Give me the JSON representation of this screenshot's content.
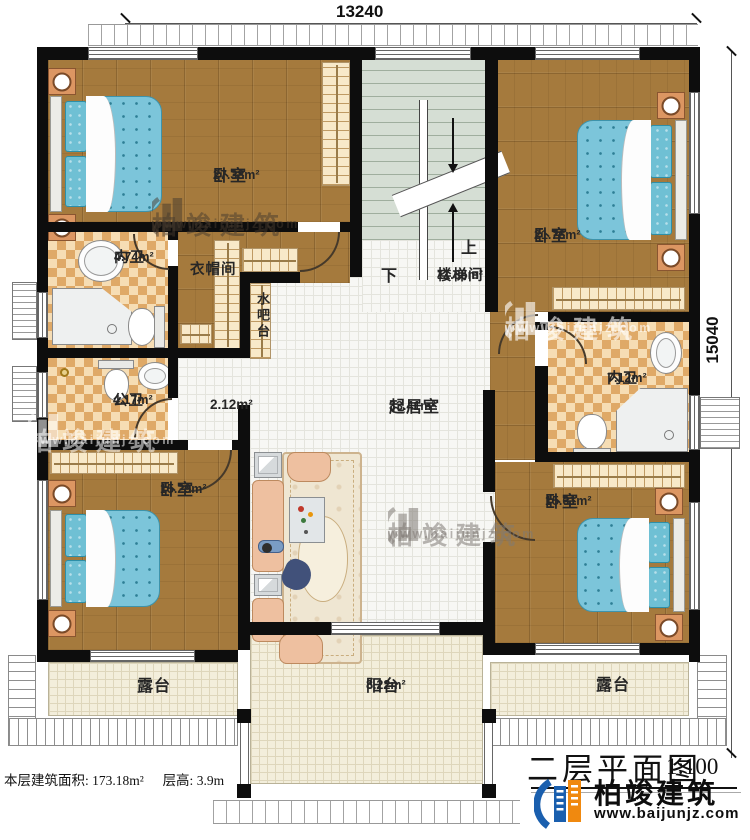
{
  "dimensions": {
    "top": "13240",
    "right": "15040"
  },
  "rooms": {
    "bedroom1": {
      "name": "卧室",
      "area": "27.38m²"
    },
    "bedroom2": {
      "name": "卧室",
      "area": "21.76m²"
    },
    "bedroom3": {
      "name": "卧室",
      "area": "15.29m²"
    },
    "bedroom4": {
      "name": "卧室",
      "area": "15.61m²"
    },
    "bath1": {
      "name": "内卫",
      "area": "4.74m²"
    },
    "bath2": {
      "name": "内卫",
      "area": "7.12m²"
    },
    "public_bath": {
      "name": "公卫",
      "area": "4.17m²"
    },
    "cloakroom": {
      "name": "衣帽间"
    },
    "water_bar": {
      "name": "水吧台"
    },
    "stairwell": {
      "name": "楼梯间",
      "area": "11.35m²",
      "up": "上",
      "down": "下"
    },
    "hallway": {
      "area": "2.12m²"
    },
    "living": {
      "name": "起居室",
      "area": "33.41m²"
    },
    "terrace_left": {
      "name": "露台"
    },
    "terrace_right": {
      "name": "露台"
    },
    "balcony": {
      "name": "阳台",
      "area": "8.22m²"
    }
  },
  "footer": {
    "floor_area_label": "本层建筑面积: 173.18m²",
    "floor_height_label": "层高: 3.9m",
    "plan_title": "二层平面图",
    "plan_scale": "1:100"
  },
  "brand": {
    "name": "柏竣建筑",
    "website": "www.baijunjz.com"
  },
  "colors": {
    "wall": "#0d0d0d",
    "wood": "#a57a3d",
    "checker": "#dfa967",
    "tile": "#f7f7f4",
    "terrace": "#f3eedb",
    "stair": "#d5ded4",
    "bed": "#7cc5da",
    "logo_blue": "#1a5fae",
    "logo_orange": "#f0890f"
  }
}
